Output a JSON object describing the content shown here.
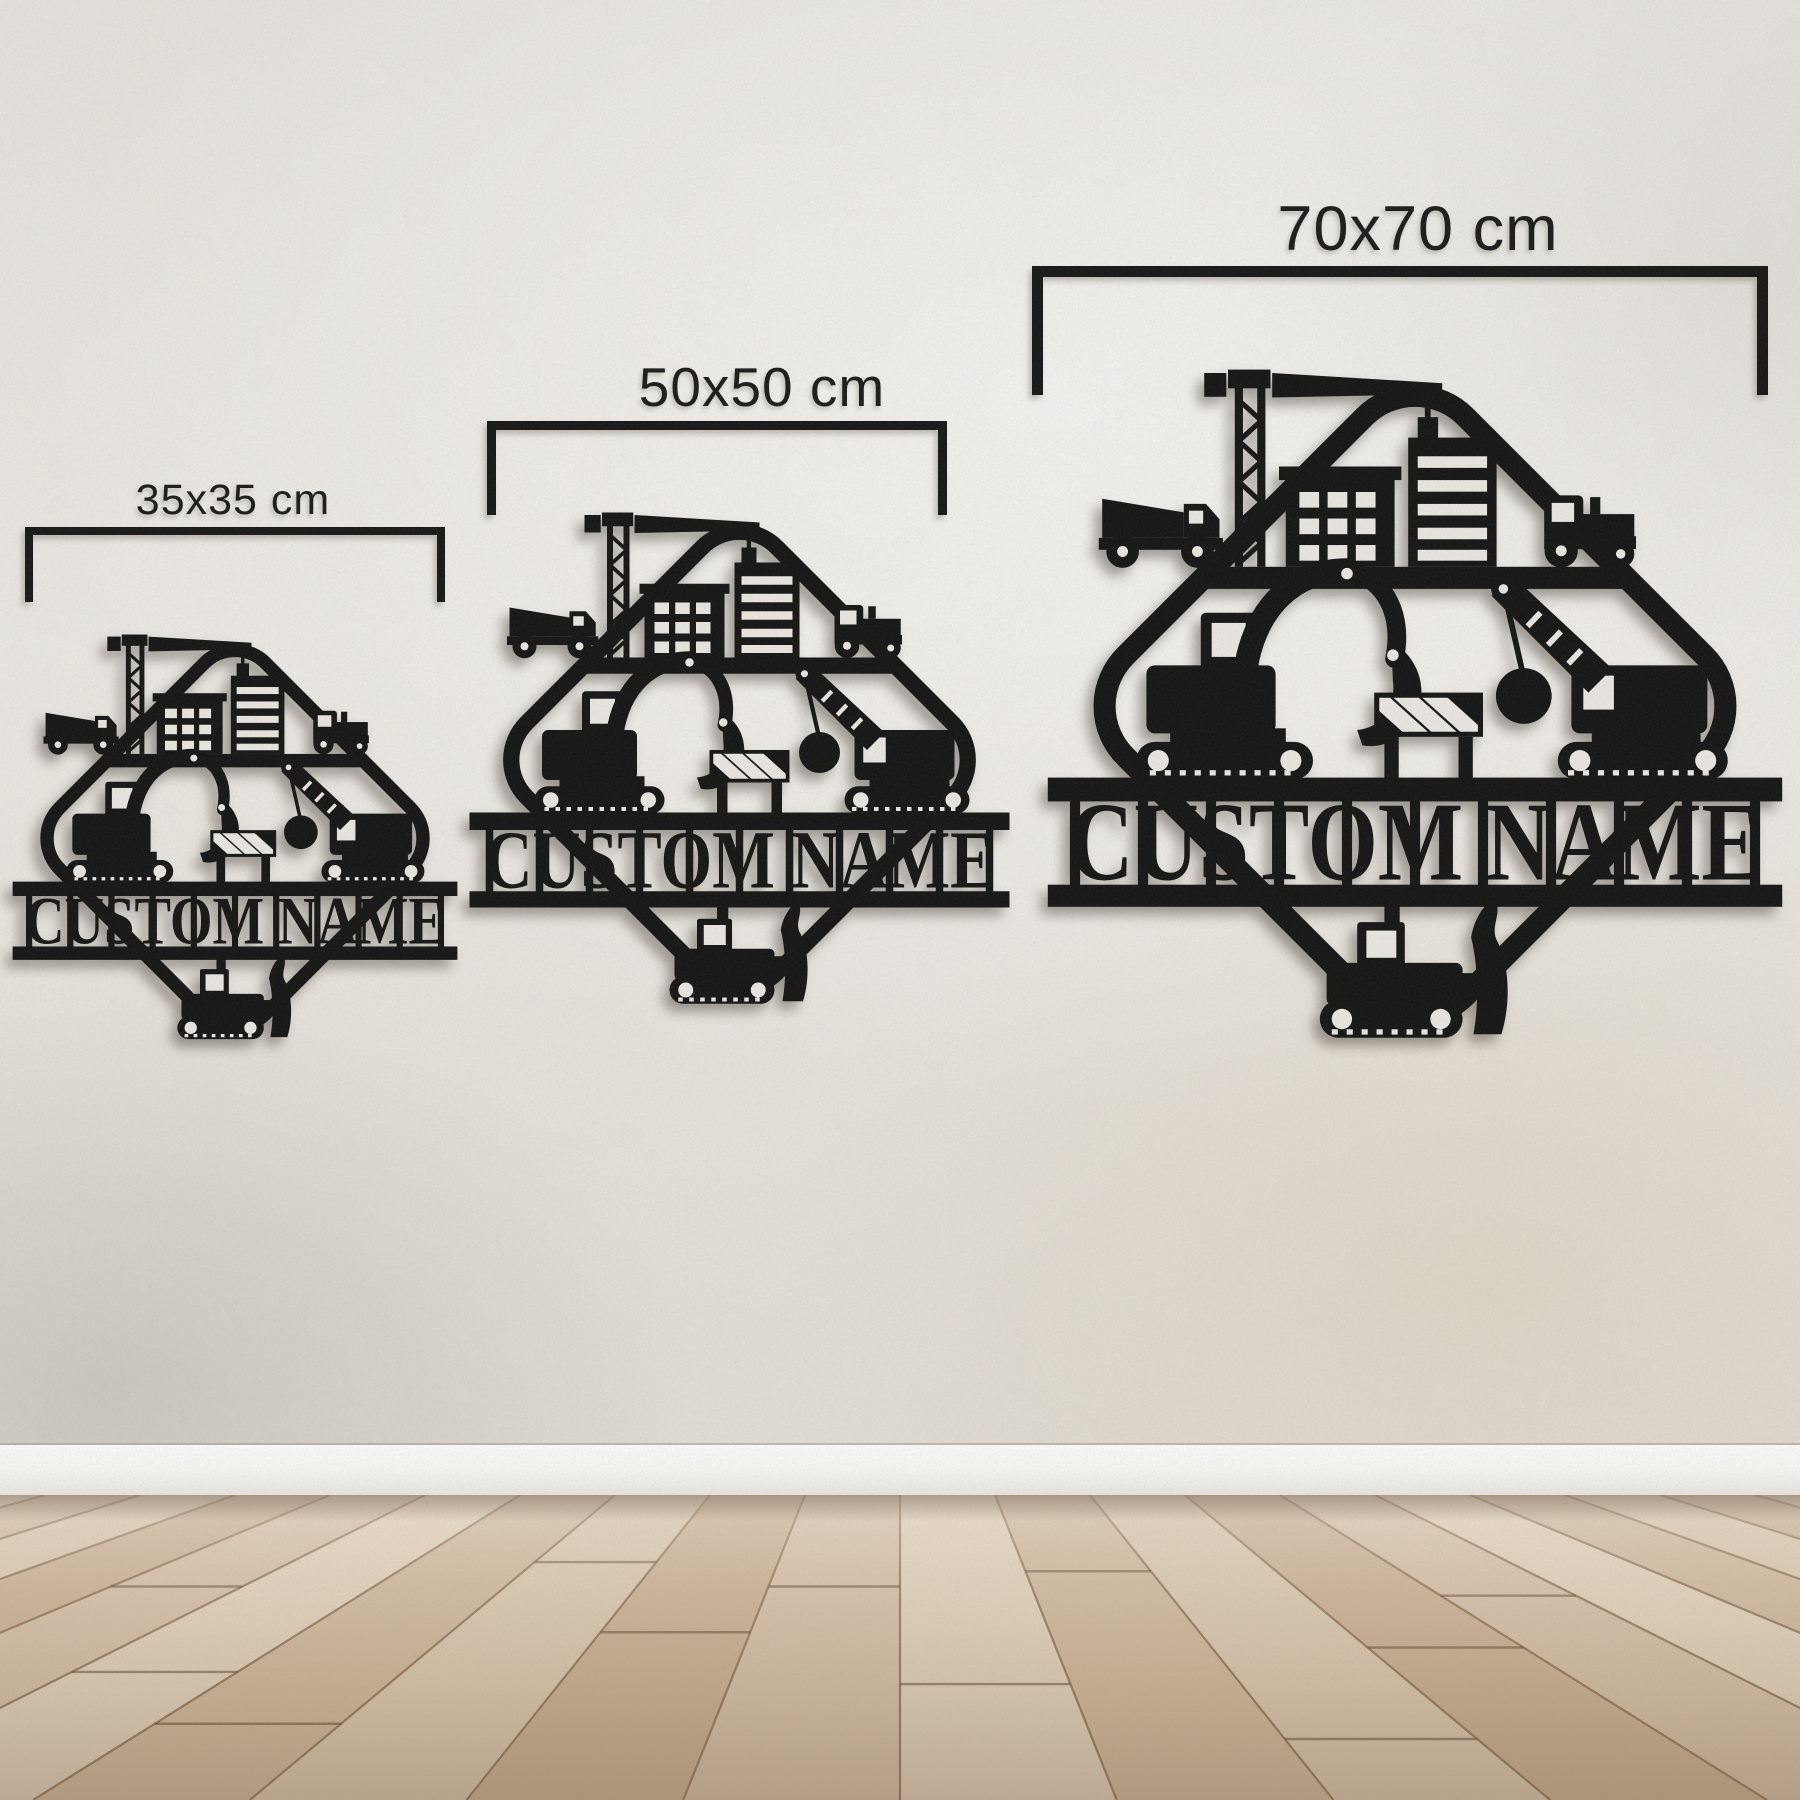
{
  "signs": [
    {
      "size_label": "35x35 cm",
      "name_text": "CUSTOM NAME"
    },
    {
      "size_label": "50x50 cm",
      "name_text": "CUSTOM NAME"
    },
    {
      "size_label": "70x70 cm",
      "name_text": "CUSTOM NAME"
    }
  ],
  "colors": {
    "sign_metal": "#141414",
    "annotation": "#1a1a1a",
    "wall": "#eae7e2",
    "baseboard": "#f7f6f3",
    "floor_light": "#dfcfb9",
    "floor_dark": "#c8af94",
    "floor_seam": "#8a6e52"
  }
}
